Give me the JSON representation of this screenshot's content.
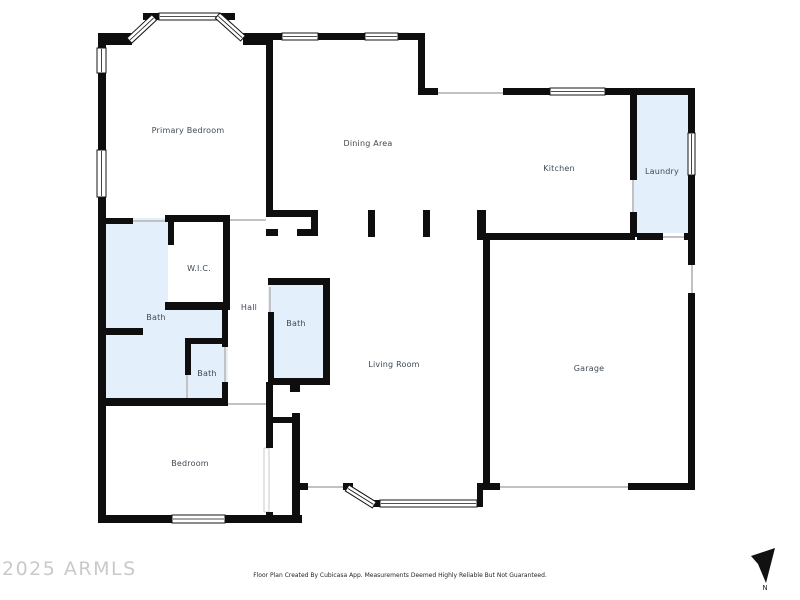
{
  "floor_plan": {
    "rooms": [
      {
        "label": "Primary Bedroom"
      },
      {
        "label": "Dining Area"
      },
      {
        "label": "Kitchen"
      },
      {
        "label": "Laundry"
      },
      {
        "label": "W.I.C."
      },
      {
        "label": "Bath"
      },
      {
        "label": "Hall"
      },
      {
        "label": "Bath"
      },
      {
        "label": "Bath"
      },
      {
        "label": "Living Room"
      },
      {
        "label": "Garage"
      },
      {
        "label": "Bedroom"
      }
    ],
    "colors": {
      "wall": "#0e0e0e",
      "wet_room_fill": "#e3effa",
      "room_label": "#3f4a54",
      "opening_line": "#c2c2c2"
    }
  },
  "footer": {
    "watermark": "2025 ARMLS",
    "disclaimer": "Floor Plan Created By Cubicasa App. Measurements Deemed Highly Reliable But Not Guaranteed.",
    "compass_label": "N"
  }
}
